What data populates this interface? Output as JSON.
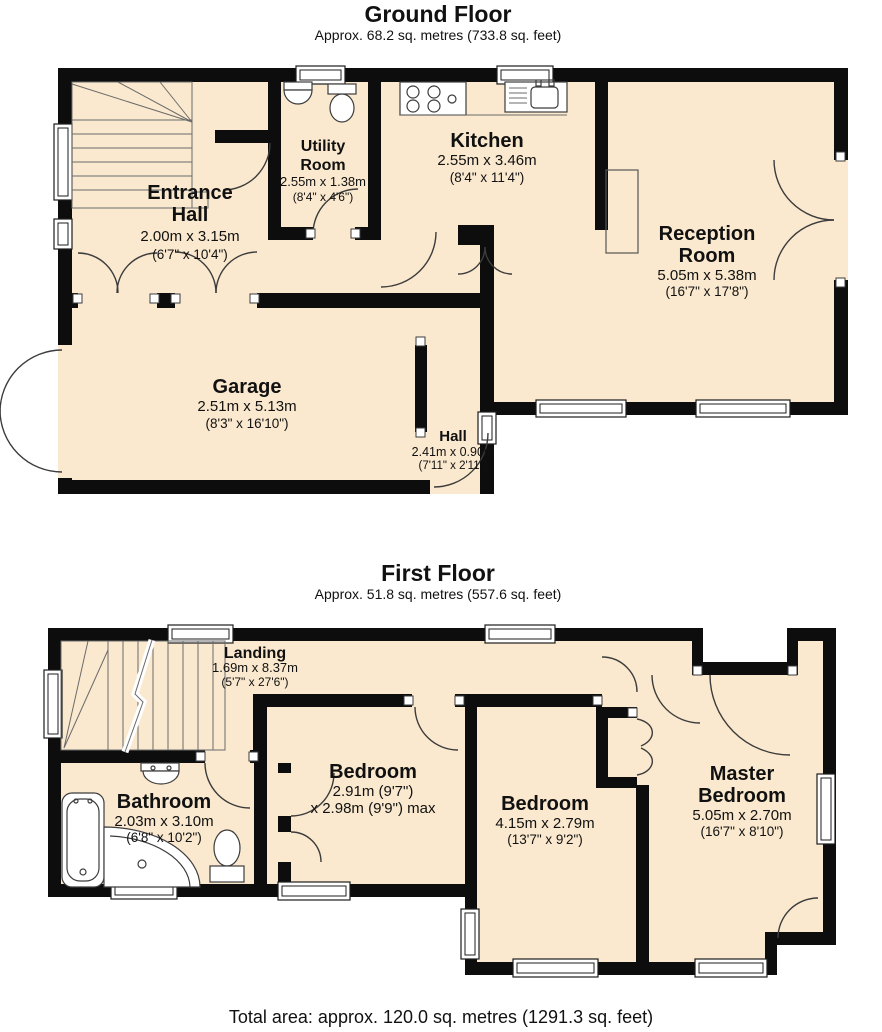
{
  "colors": {
    "floor": "#FAE9CE",
    "wall": "#0D0D0D",
    "line": "#3C3C3C",
    "window_fill": "#FFFFFF",
    "background": "#FFFFFF",
    "text": "#111111"
  },
  "ground": {
    "title": "Ground Floor",
    "subtitle": "Approx. 68.2 sq. metres (733.8 sq. feet)",
    "entrance_hall": {
      "line1": "Entrance",
      "line2": "Hall",
      "m": "2.00m x 3.15m",
      "ft": "(6'7\" x 10'4\")"
    },
    "utility_room": {
      "line1": "Utility",
      "line2": "Room",
      "m": "2.55m x 1.38m",
      "ft": "(8'4\" x 4'6\")"
    },
    "kitchen": {
      "line1": "Kitchen",
      "m": "2.55m x 3.46m",
      "ft": "(8'4\" x 11'4\")"
    },
    "reception_room": {
      "line1": "Reception",
      "line2": "Room",
      "m": "5.05m x 5.38m",
      "ft": "(16'7\" x 17'8\")"
    },
    "garage": {
      "line1": "Garage",
      "m": "2.51m x 5.13m",
      "ft": "(8'3\" x 16'10\")"
    },
    "hall": {
      "line1": "Hall",
      "m": "2.41m x 0.90m",
      "ft": "(7'11\" x 2'11\")"
    }
  },
  "first": {
    "title": "First Floor",
    "subtitle": "Approx. 51.8 sq. metres (557.6 sq. feet)",
    "landing": {
      "line1": "Landing",
      "m": "1.69m x 8.37m",
      "ft": "(5'7\" x 27'6\")"
    },
    "bathroom": {
      "line1": "Bathroom",
      "m": "2.03m x 3.10m",
      "ft": "(6'8\" x 10'2\")"
    },
    "bedroom_small": {
      "line1": "Bedroom",
      "m": "2.91m (9'7\")",
      "ft": "x 2.98m (9'9\") max"
    },
    "bedroom_large": {
      "line1": "Bedroom",
      "m": "4.15m x 2.79m",
      "ft": "(13'7\" x 9'2\")"
    },
    "master_bedroom": {
      "line1": "Master",
      "line2": "Bedroom",
      "m": "5.05m x 2.70m",
      "ft": "(16'7\" x 8'10\")"
    }
  },
  "footer": "Total area: approx. 120.0 sq. metres (1291.3 sq. feet)"
}
